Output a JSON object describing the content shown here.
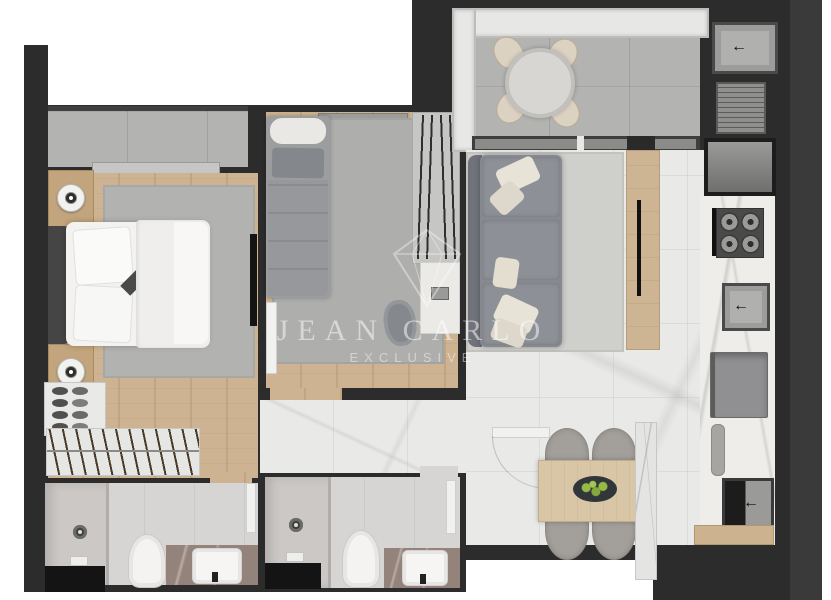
{
  "watermark": {
    "brand": "JEAN CARLO",
    "tagline": "EXCLUSIVE",
    "logo": "diamond-outline-icon",
    "color": "#ffffff"
  },
  "icons": {
    "faucet_arrow": "←"
  },
  "palette": {
    "page_background": "#ffffff",
    "wall_mass": "#2c2c2c",
    "backdrop_margin": "#3a3a3a",
    "wood_floor": "#cdb391",
    "marble_tile_floor": "#e9e9e7",
    "balcony_concrete": "#b3b3b1",
    "bathroom_floor": "#d7d5d3",
    "vanity_stone": "#93837a",
    "rug_gray": "#b2b2b0",
    "sofa_gray": "#8a8e93",
    "pillow_cream": "#e8e3d7",
    "tv_panel_wood": "#cdb493",
    "dining_table_wood": "#d9c6a7",
    "fruit_green": "#97ba45"
  },
  "rooms": [
    {
      "name": "master-bedroom",
      "furniture": [
        "double-bed",
        "headboard",
        "pillows",
        "nightstand-top",
        "nightstand-bottom",
        "table-lamps",
        "area-rug",
        "tv-wall-panel",
        "shoe-rack",
        "closet-hanger-rail",
        "window-ledge"
      ]
    },
    {
      "name": "second-bedroom",
      "furniture": [
        "single-bed",
        "area-rug",
        "wardrobe-hangers",
        "desk",
        "desk-chair",
        "door-leaf",
        "window-sill"
      ]
    },
    {
      "name": "balcony",
      "furniture": [
        "round-table",
        "four-chairs",
        "railing",
        "sliding-glass-door"
      ]
    },
    {
      "name": "living-room",
      "furniture": [
        "three-seat-sofa",
        "cream-pillows",
        "area-rug",
        "tv-console",
        "tv",
        "entry-door",
        "dining-table",
        "four-dining-chairs",
        "fruit-bowl",
        "kitchen-island"
      ]
    },
    {
      "name": "kitchen",
      "furniture": [
        "laundry-tank",
        "drying-rack",
        "service-shaft",
        "gas-stove",
        "kitchen-sink",
        "refrigerator",
        "cutting-board",
        "second-sink",
        "wood-threshold"
      ]
    },
    {
      "name": "bathroom-1",
      "furniture": [
        "shower",
        "glass-partition",
        "toilet",
        "stone-vanity",
        "basin",
        "service-shaft",
        "door-leaf"
      ]
    },
    {
      "name": "bathroom-2",
      "furniture": [
        "shower",
        "glass-partition",
        "toilet",
        "stone-vanity",
        "basin",
        "service-shaft",
        "door-leaf"
      ]
    }
  ]
}
